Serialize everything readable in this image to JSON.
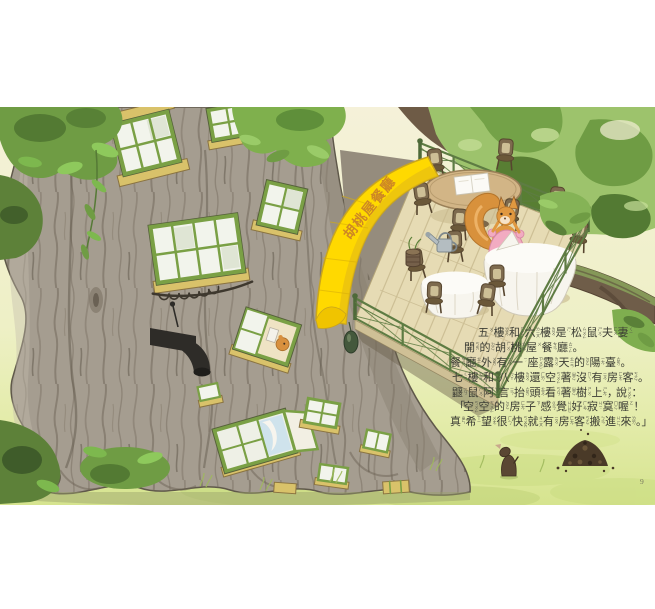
{
  "page": {
    "number": "9"
  },
  "illustration": {
    "awning_sign": "胡桃屋餐廳",
    "colors": {
      "awning_yellow": "#ffd900",
      "railing_green": "#5e7c43",
      "leaf_bright": "#8ec95c",
      "leaf_dark": "#537a33",
      "trunk_grey": "#a59d90",
      "grass_green": "#dce794",
      "squirrel_orange": "#e09840",
      "dress_pink": "#f2abc1",
      "window_frame_green": "#7aa045",
      "sill_yellow": "#d9c26a",
      "text_dark": "#3c3d35"
    }
  },
  "story": {
    "full_text": "五樓和六樓是松鼠夫妻開的胡桃屋餐廳。餐廳外有一座露天的陽臺。七樓和八樓還空著沒有房客。鼴鼠阿言抬頭看著樹上，說：「空空的房子感覺好寂寞喔！真希望很快就有房客搬進來。」",
    "lines": [
      {
        "indent": 28,
        "chars": [
          [
            "五",
            "ㄨˇ"
          ],
          [
            "樓",
            "ㄌㄡˊ"
          ],
          [
            "和",
            "ㄏㄜˊ"
          ],
          [
            "六",
            "ㄌㄧㄡˋ"
          ],
          [
            "樓",
            "ㄌㄡˊ"
          ],
          [
            "是",
            "ㄕˋ"
          ],
          [
            "松",
            "ㄙㄨㄥ"
          ],
          [
            "鼠",
            "ㄕㄨˇ"
          ],
          [
            "夫",
            "ㄈㄨ"
          ],
          [
            "妻",
            "ㄑㄧ"
          ]
        ]
      },
      {
        "indent": 14,
        "chars": [
          [
            "開",
            "ㄎㄞ"
          ],
          [
            "的",
            "ㄉㄜ˙"
          ],
          [
            "胡",
            "ㄏㄨˊ"
          ],
          [
            "桃",
            "ㄊㄠˊ"
          ],
          [
            "屋",
            "ㄨ"
          ],
          [
            "餐",
            "ㄘㄢ"
          ],
          [
            "廳",
            "ㄊㄧㄥ"
          ],
          [
            "。",
            ""
          ]
        ]
      },
      {
        "indent": 0,
        "chars": [
          [
            "餐",
            "ㄘㄢ"
          ],
          [
            "廳",
            "ㄊㄧㄥ"
          ],
          [
            "外",
            "ㄨㄞˋ"
          ],
          [
            "有",
            "ㄧㄡˇ"
          ],
          [
            "一",
            "ㄧˊ"
          ],
          [
            "座",
            "ㄗㄨㄛˋ"
          ],
          [
            "露",
            "ㄌㄨˋ"
          ],
          [
            "天",
            "ㄊㄧㄢ"
          ],
          [
            "的",
            "ㄉㄜ˙"
          ],
          [
            "陽",
            "ㄧㄤˊ"
          ],
          [
            "臺",
            "ㄊㄞˊ"
          ],
          [
            "。",
            ""
          ]
        ]
      },
      {
        "indent": 2,
        "chars": [
          [
            "七",
            "ㄑㄧ"
          ],
          [
            "樓",
            "ㄌㄡˊ"
          ],
          [
            "和",
            "ㄏㄜˊ"
          ],
          [
            "八",
            "ㄅㄚ"
          ],
          [
            "樓",
            "ㄌㄡˊ"
          ],
          [
            "還",
            "ㄏㄞˊ"
          ],
          [
            "空",
            "ㄎㄨㄥ"
          ],
          [
            "著",
            "ㄓㄜ˙"
          ],
          [
            "沒",
            "ㄇㄟˊ"
          ],
          [
            "有",
            "ㄧㄡˇ"
          ],
          [
            "房",
            "ㄈㄤˊ"
          ],
          [
            "客",
            "ㄎㄜˋ"
          ],
          [
            "。",
            ""
          ]
        ]
      },
      {
        "indent": 2,
        "chars": [
          [
            "鼴",
            "ㄧㄢˇ"
          ],
          [
            "鼠",
            "ㄕㄨˇ"
          ],
          [
            "阿",
            "ㄚ"
          ],
          [
            "言",
            "ㄧㄢˊ"
          ],
          [
            "抬",
            "ㄊㄞˊ"
          ],
          [
            "頭",
            "ㄊㄡˊ"
          ],
          [
            "看",
            "ㄎㄢˋ"
          ],
          [
            "著",
            "ㄓㄜ˙"
          ],
          [
            "樹",
            "ㄕㄨˋ"
          ],
          [
            "上",
            "ㄕㄤˋ"
          ],
          [
            "，",
            ""
          ],
          [
            "說",
            "ㄕㄨㄛ"
          ],
          [
            "：",
            ""
          ]
        ]
      },
      {
        "indent": 4,
        "chars": [
          [
            "「",
            ""
          ],
          [
            "空",
            "ㄎㄨㄥ"
          ],
          [
            "空",
            "ㄎㄨㄥ"
          ],
          [
            "的",
            "ㄉㄜ˙"
          ],
          [
            "房",
            "ㄈㄤˊ"
          ],
          [
            "子",
            "ㄗ˙"
          ],
          [
            "感",
            "ㄍㄢˇ"
          ],
          [
            "覺",
            "ㄐㄩㄝˊ"
          ],
          [
            "好",
            "ㄏㄠˇ"
          ],
          [
            "寂",
            "ㄐㄧˊ"
          ],
          [
            "寞",
            "ㄇㄛˋ"
          ],
          [
            "喔",
            "ㄛ"
          ],
          [
            "！",
            ""
          ]
        ]
      },
      {
        "indent": 0,
        "chars": [
          [
            "真",
            "ㄓㄣ"
          ],
          [
            "希",
            "ㄒㄧ"
          ],
          [
            "望",
            "ㄨㄤˋ"
          ],
          [
            "很",
            "ㄏㄣˇ"
          ],
          [
            "快",
            "ㄎㄨㄞˋ"
          ],
          [
            "就",
            "ㄐㄧㄡˋ"
          ],
          [
            "有",
            "ㄧㄡˇ"
          ],
          [
            "房",
            "ㄈㄤˊ"
          ],
          [
            "客",
            "ㄎㄜˋ"
          ],
          [
            "搬",
            "ㄅㄢ"
          ],
          [
            "進",
            "ㄐㄧㄣˋ"
          ],
          [
            "來",
            "ㄌㄞˊ"
          ],
          [
            "。」",
            ""
          ]
        ]
      }
    ]
  }
}
